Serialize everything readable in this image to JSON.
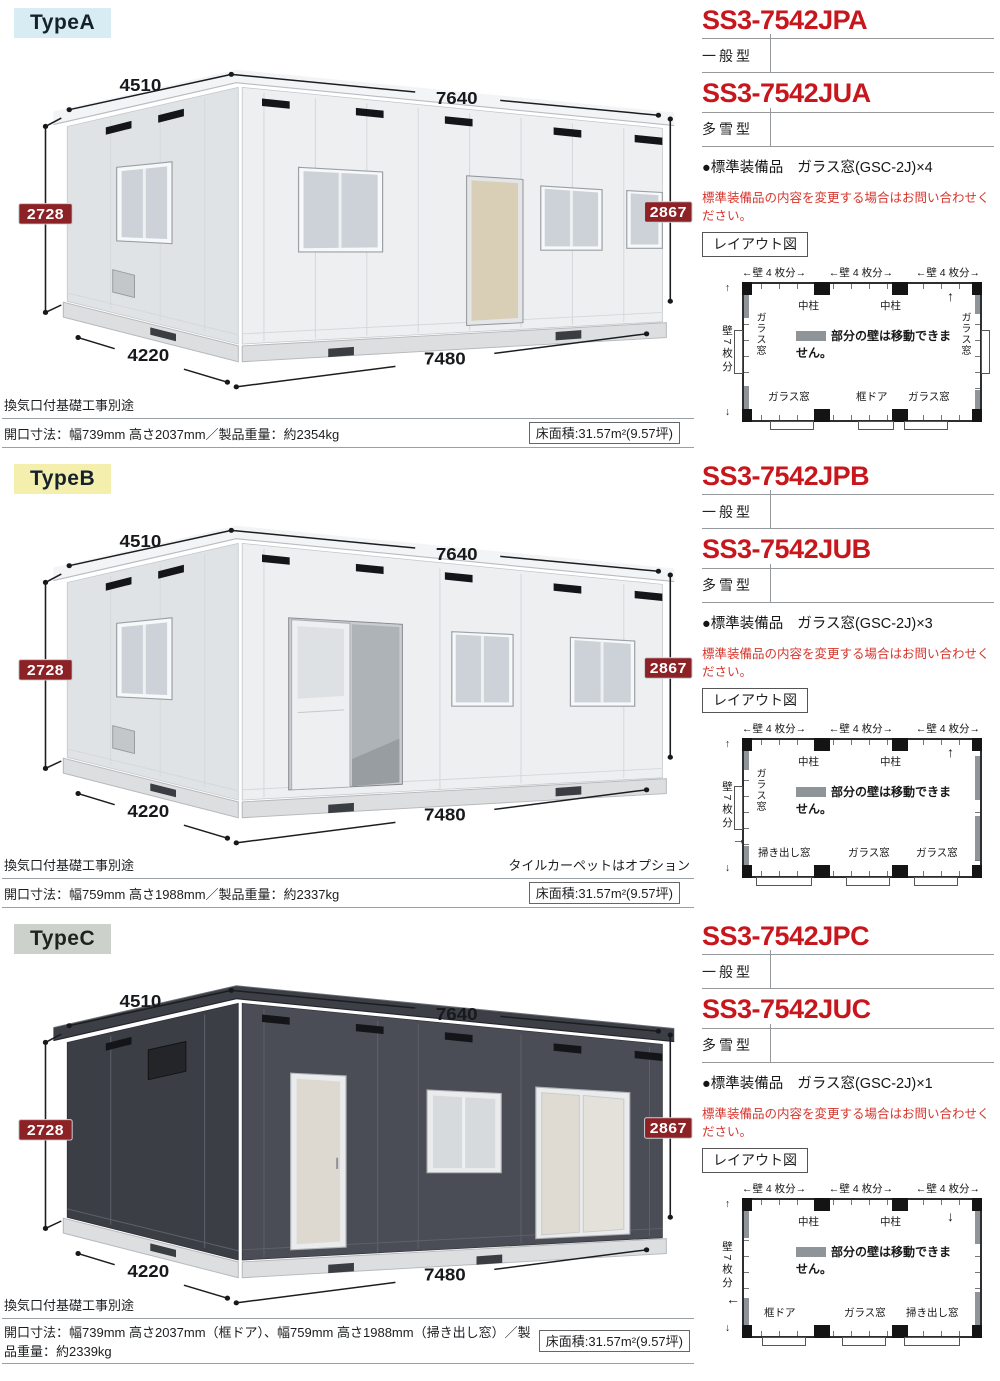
{
  "sections": [
    {
      "id": "A",
      "type_label": "TypeA",
      "dims": {
        "depth": "4510",
        "width": "7640",
        "height_left": "2728",
        "height_right": "2867",
        "bottom_depth": "4220",
        "bottom_width": "7480"
      },
      "codes": [
        {
          "code": "SS3-7542JPA",
          "variant": "一般型"
        },
        {
          "code": "SS3-7542JUA",
          "variant": "多雪型"
        }
      ],
      "equipment": {
        "label": "●標準装備品",
        "value": "ガラス窓(GSC-2J)×4"
      },
      "warning": "標準装備品の内容を変更する場合はお問い合わせください。",
      "layout_button": "レイアウト図",
      "diagram": {
        "top_labels": [
          "←壁 4 枚分→",
          "←壁 4 枚分→",
          "←壁 4 枚分→"
        ],
        "side_label": "壁7枚分",
        "up_arrow": "↑",
        "down_arrow": "↓",
        "top_arrow": "↑",
        "side_arrow": "→",
        "pillars": [
          "中柱",
          "中柱"
        ],
        "legend": "部分の壁は移動できません。",
        "left_window": "ガラス窓",
        "right_window": "ガラス窓",
        "bottom_labels": [
          "ガラス窓",
          "框ドア",
          "ガラス窓"
        ]
      },
      "foundation_note": "換気口付基礎工事別途",
      "option_note": "",
      "spec": "開口寸法：幅739mm 高さ2037mm／製品重量：約2354kg",
      "floor_area": "床面積:31.57m²(9.57坪)"
    },
    {
      "id": "B",
      "type_label": "TypeB",
      "dims": {
        "depth": "4510",
        "width": "7640",
        "height_left": "2728",
        "height_right": "2867",
        "bottom_depth": "4220",
        "bottom_width": "7480"
      },
      "codes": [
        {
          "code": "SS3-7542JPB",
          "variant": "一般型"
        },
        {
          "code": "SS3-7542JUB",
          "variant": "多雪型"
        }
      ],
      "equipment": {
        "label": "●標準装備品",
        "value": "ガラス窓(GSC-2J)×3"
      },
      "warning": "標準装備品の内容を変更する場合はお問い合わせください。",
      "layout_button": "レイアウト図",
      "diagram": {
        "top_labels": [
          "←壁 4 枚分→",
          "←壁 4 枚分→",
          "←壁 4 枚分→"
        ],
        "side_label": "壁7枚分",
        "up_arrow": "↑",
        "down_arrow": "↓",
        "top_arrow": "↑",
        "side_arrow": "→",
        "pillars": [
          "中柱",
          "中柱"
        ],
        "legend": "部分の壁は移動できません。",
        "left_window": "ガラス窓",
        "right_window": "",
        "bottom_labels": [
          "掃き出し窓",
          "ガラス窓",
          "ガラス窓"
        ]
      },
      "foundation_note": "換気口付基礎工事別途",
      "option_note": "タイルカーペットはオプション",
      "spec": "開口寸法：幅759mm 高さ1988mm／製品重量：約2337kg",
      "floor_area": "床面積:31.57m²(9.57坪)"
    },
    {
      "id": "C",
      "type_label": "TypeC",
      "dims": {
        "depth": "4510",
        "width": "7640",
        "height_left": "2728",
        "height_right": "2867",
        "bottom_depth": "4220",
        "bottom_width": "7480"
      },
      "codes": [
        {
          "code": "SS3-7542JPC",
          "variant": "一般型"
        },
        {
          "code": "SS3-7542JUC",
          "variant": "多雪型"
        }
      ],
      "equipment": {
        "label": "●標準装備品",
        "value": "ガラス窓(GSC-2J)×1"
      },
      "warning": "標準装備品の内容を変更する場合はお問い合わせください。",
      "layout_button": "レイアウト図",
      "diagram": {
        "top_labels": [
          "←壁 4 枚分→",
          "←壁 4 枚分→",
          "←壁 4 枚分→"
        ],
        "side_label": "壁7枚分",
        "up_arrow": "↑",
        "down_arrow": "↓",
        "top_arrow": "↓",
        "side_arrow": "←",
        "pillars": [
          "中柱",
          "中柱"
        ],
        "legend": "部分の壁は移動できません。",
        "left_window": "",
        "right_window": "",
        "bottom_labels": [
          "框ドア",
          "ガラス窓",
          "掃き出し窓"
        ]
      },
      "foundation_note": "換気口付基礎工事別途",
      "option_note": "",
      "spec": "開口寸法：幅739mm 高さ2037mm（框ドア）、幅759mm 高さ1988mm（掃き出し窓）／製品重量：約2339kg",
      "floor_area": "床面積:31.57m²(9.57坪)"
    }
  ]
}
